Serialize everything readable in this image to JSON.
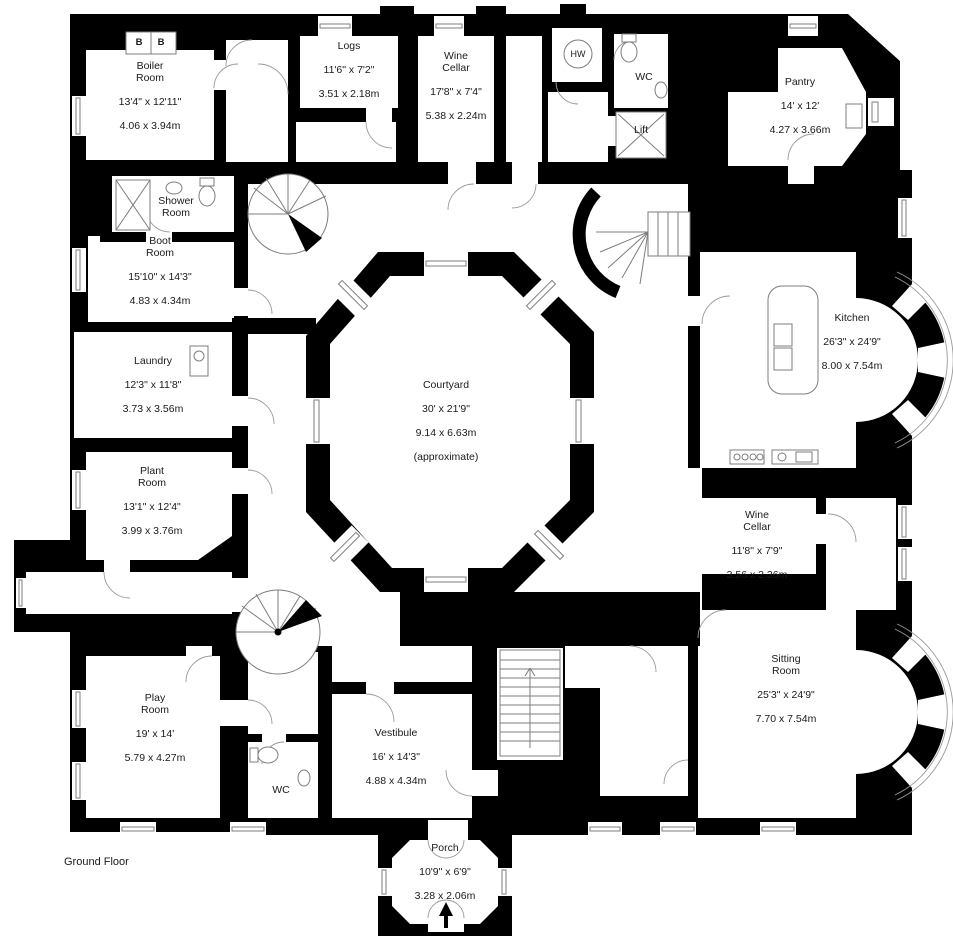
{
  "floor": {
    "label": "Ground Floor"
  },
  "annotations": {
    "boiler_b_left": "B",
    "boiler_b_right": "B"
  },
  "colors": {
    "wall": "#000000",
    "background": "#ffffff",
    "line": "#7d7d7d",
    "text": "#1a1a1a"
  },
  "rooms": {
    "boiler_room": {
      "name": "Boiler\nRoom",
      "dims_ft": "13'4\" x 12'11\"",
      "dims_m": "4.06 x 3.94m"
    },
    "logs": {
      "name": "Logs",
      "dims_ft": "11'6\" x 7'2\"",
      "dims_m": "3.51 x 2.18m"
    },
    "wine_cellar_top": {
      "name": "Wine\nCellar",
      "dims_ft": "17'8\" x 7'4\"",
      "dims_m": "5.38 x 2.24m"
    },
    "hw": {
      "name": "HW"
    },
    "wc_top": {
      "name": "WC"
    },
    "lift": {
      "name": "Lift"
    },
    "pantry": {
      "name": "Pantry",
      "dims_ft": "14' x 12'",
      "dims_m": "4.27 x 3.66m"
    },
    "shower_room": {
      "name": "Shower\nRoom"
    },
    "boot_room": {
      "name": "Boot\nRoom",
      "dims_ft": "15'10\" x 14'3\"",
      "dims_m": "4.83 x 4.34m"
    },
    "laundry": {
      "name": "Laundry",
      "dims_ft": "12'3\" x 11'8\"",
      "dims_m": "3.73 x 3.56m"
    },
    "plant_room": {
      "name": "Plant\nRoom",
      "dims_ft": "13'1\" x 12'4\"",
      "dims_m": "3.99 x 3.76m"
    },
    "courtyard": {
      "name": "Courtyard",
      "dims_ft": "30' x 21'9\"",
      "dims_m": "9.14 x 6.63m",
      "note": "(approximate)"
    },
    "kitchen": {
      "name": "Kitchen",
      "dims_ft": "26'3\" x 24'9\"",
      "dims_m": "8.00 x 7.54m"
    },
    "wine_cellar_right": {
      "name": "Wine\nCellar",
      "dims_ft": "11'8\" x 7'9\"",
      "dims_m": "3.56 x 2.36m"
    },
    "sitting_room": {
      "name": "Sitting\nRoom",
      "dims_ft": "25'3\" x 24'9\"",
      "dims_m": "7.70 x 7.54m"
    },
    "play_room": {
      "name": "Play\nRoom",
      "dims_ft": "19' x 14'",
      "dims_m": "5.79 x 4.27m"
    },
    "wc_bottom": {
      "name": "WC"
    },
    "vestibule": {
      "name": "Vestibule",
      "dims_ft": "16' x 14'3\"",
      "dims_m": "4.88 x 4.34m"
    },
    "porch": {
      "name": "Porch",
      "dims_ft": "10'9\" x 6'9\"",
      "dims_m": "3.28 x 2.06m"
    }
  }
}
